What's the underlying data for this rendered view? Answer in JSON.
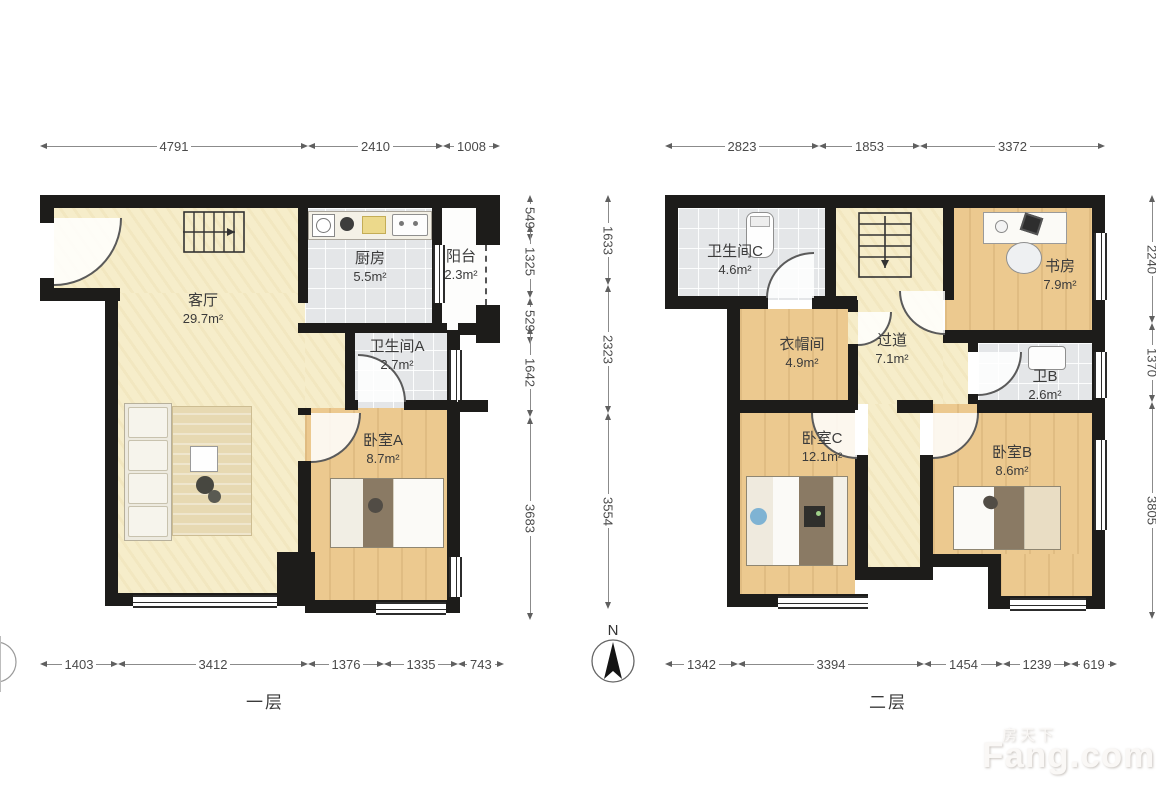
{
  "floor1": {
    "label": "一层",
    "rooms": {
      "living": {
        "name": "客厅",
        "area": "29.7m²"
      },
      "kitchen": {
        "name": "厨房",
        "area": "5.5m²"
      },
      "balcony": {
        "name": "阳台",
        "area": "2.3m²"
      },
      "bathA": {
        "name": "卫生间A",
        "area": "2.7m²"
      },
      "bedA": {
        "name": "卧室A",
        "area": "8.7m²"
      }
    },
    "dims_top": [
      "4791",
      "2410",
      "1008"
    ],
    "dims_bottom": [
      "1403",
      "3412",
      "1376",
      "1335",
      "743"
    ],
    "dims_right": [
      "549",
      "1325",
      "529",
      "1642",
      "3683"
    ]
  },
  "floor2": {
    "label": "二层",
    "rooms": {
      "bathC": {
        "name": "卫生间C",
        "area": "4.6m²"
      },
      "study": {
        "name": "书房",
        "area": "7.9m²"
      },
      "cloak": {
        "name": "衣帽间",
        "area": "4.9m²"
      },
      "hall": {
        "name": "过道",
        "area": "7.1m²"
      },
      "bathB": {
        "name": "卫B",
        "area": "2.6m²"
      },
      "bedC": {
        "name": "卧室C",
        "area": "12.1m²"
      },
      "bedB": {
        "name": "卧室B",
        "area": "8.6m²"
      }
    },
    "dims_top": [
      "2823",
      "1853",
      "3372"
    ],
    "dims_bottom": [
      "1342",
      "3394",
      "1454",
      "1239",
      "619"
    ],
    "dims_left": [
      "1633",
      "2323",
      "3554"
    ],
    "dims_right": [
      "2240",
      "1370",
      "3805"
    ]
  },
  "compass": {
    "north_label": "N"
  },
  "watermark": {
    "brand_cn": "房天下",
    "brand_en": "Fang.com"
  },
  "colors": {
    "wall": "#1d1c1a",
    "floor_cream": "#f6edca",
    "floor_wood": "#ecc98f",
    "floor_tile": "#e4e6e8",
    "dim_text": "#4a4a4a",
    "label_text": "#3b3b3b"
  }
}
